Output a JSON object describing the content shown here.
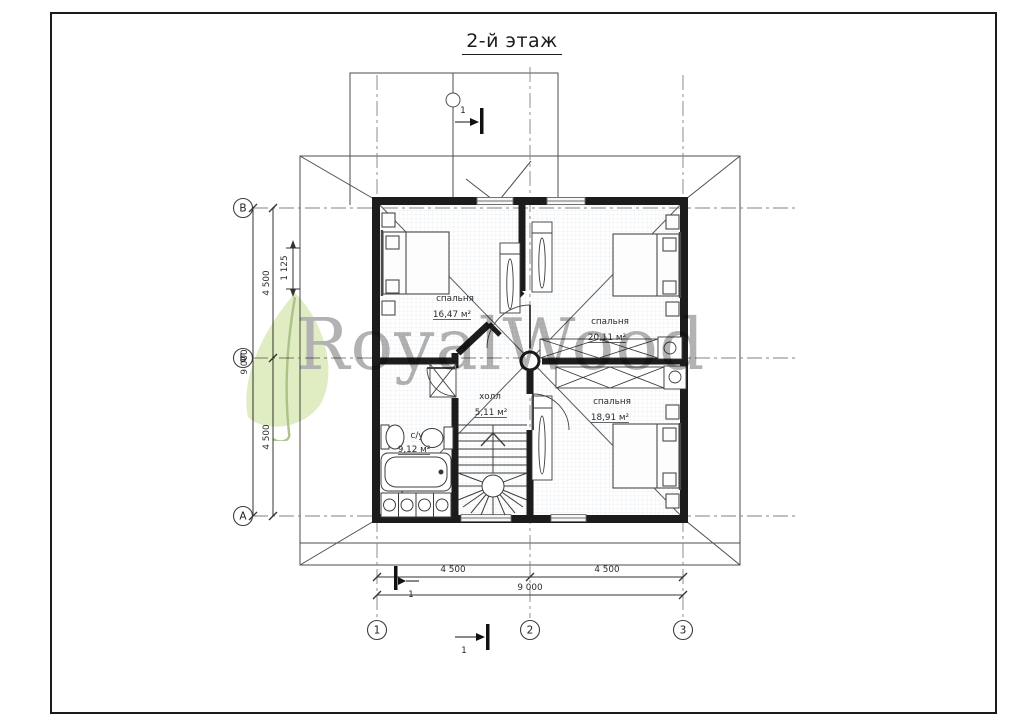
{
  "title": "2-й этаж",
  "watermark": {
    "text": "RoyalWood",
    "leaf_color": "#cde09c",
    "stem_color": "#7fa14e",
    "text_color": "#8d8d8d"
  },
  "rooms": [
    {
      "name": "спальня",
      "area": "16,47 м²"
    },
    {
      "name": "спальня",
      "area": "20,11 м²"
    },
    {
      "name": "спальня",
      "area": "18,91 м²"
    },
    {
      "name": "холл",
      "area": "5,11 м²"
    },
    {
      "name": "с/у",
      "area": "9,12 м²"
    }
  ],
  "axes": {
    "h": [
      "В",
      "Б",
      "А"
    ],
    "v": [
      "1",
      "2",
      "3"
    ]
  },
  "dims": {
    "left_total": "9 000",
    "left_upper": "4 500",
    "left_lower": "4 500",
    "left_offset": "1 125",
    "bottom_left": "4 500",
    "bottom_right": "4 500",
    "bottom_total": "9 000"
  },
  "section": {
    "label": "1"
  }
}
